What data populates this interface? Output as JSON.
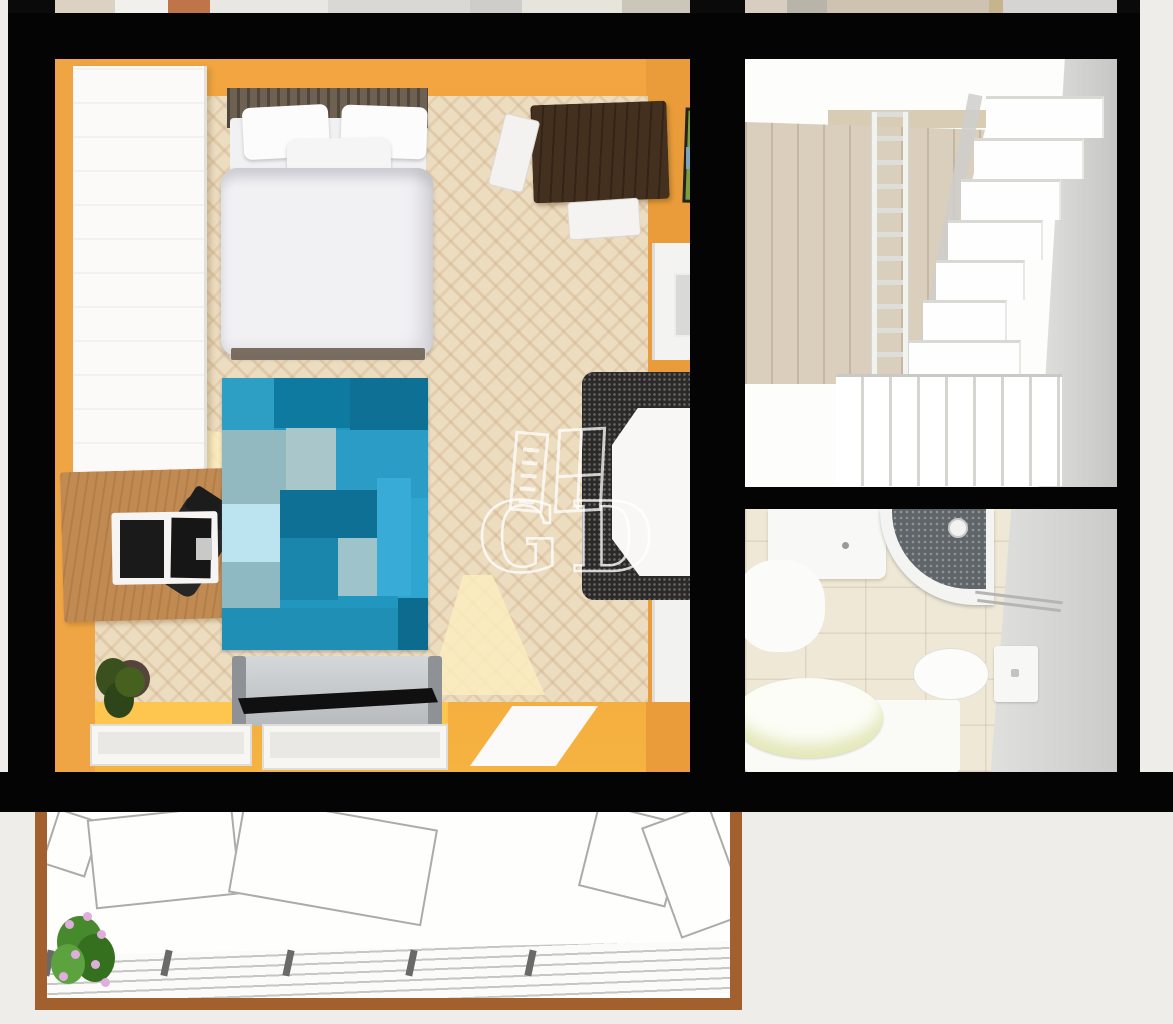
{
  "watermark": {
    "letter_left": "G",
    "letter_right": "D",
    "icons": [
      "ladder-icon",
      "window-frame-icon"
    ],
    "color": "#FFFFFF"
  },
  "palette": {
    "background": "#EFEDE9",
    "wall_black": "#040404",
    "bedroom_wall_orange": "#F2A440",
    "parquet_floor": "#ECDCC0",
    "wardrobe_white": "#FBFAF8",
    "desk_wood": "#C08A52",
    "bed_frame_wood": "#6E6152",
    "bedding_white": "#F1F0F2",
    "rug_base_blue": "#2196BF",
    "tv_stand_silver": "#C9CCCE",
    "tv_black": "#101010",
    "dining_table_dark_wood": "#44301F",
    "stair_white": "#FEFEFE",
    "stair_room_floor_tan": "#DACFBD",
    "bathroom_tile_beige": "#EFE8D7",
    "bathroom_wall_gray": "#CBCBC9",
    "balcony_frame_brown": "#A2602E",
    "plant_green": "#478A2E",
    "flower_pink": "#DFAEDC"
  },
  "scene": {
    "rooms": [
      {
        "name": "bedroom",
        "wall_color": "#F2A440",
        "furniture": [
          "wardrobe",
          "desk",
          "laptop",
          "office-chair",
          "double-bed",
          "pillows",
          "duvet",
          "patchwork-rug",
          "tv-stand",
          "tv",
          "dining-table",
          "white-chairs",
          "speckled-armchair",
          "potted-plant",
          "picture-frame",
          "door-upper",
          "door-lower",
          "window-sills"
        ]
      },
      {
        "name": "staircase-hall",
        "features": [
          "white-staircase",
          "ladder-railing",
          "balustrade",
          "tan-wood-floor",
          "gray-wall"
        ]
      },
      {
        "name": "bathroom",
        "fixtures": [
          "vanity-sink",
          "corner-shower",
          "glass-shelf",
          "toilet",
          "cistern",
          "bathtub"
        ]
      },
      {
        "name": "balcony",
        "features": [
          "brown-wood-frame",
          "plank-decking",
          "railing-posts",
          "open-window-sashes",
          "flowering-plant"
        ]
      }
    ]
  },
  "upper_strip": {
    "segments": [
      {
        "left": 47,
        "width": 60,
        "color": "#DCD2C2"
      },
      {
        "left": 107,
        "width": 55,
        "color": "#F1F0ED"
      },
      {
        "left": 160,
        "width": 42,
        "color": "#C0744A"
      },
      {
        "left": 202,
        "width": 118,
        "color": "#E9E7E3"
      },
      {
        "left": 320,
        "width": 142,
        "color": "#DAD8D4"
      },
      {
        "left": 462,
        "width": 52,
        "color": "#CFCDC9"
      },
      {
        "left": 514,
        "width": 100,
        "color": "#E7E4DC"
      },
      {
        "left": 614,
        "width": 68,
        "color": "#CCC6BA"
      },
      {
        "left": 737,
        "width": 42,
        "color": "#D7CEC1"
      },
      {
        "left": 779,
        "width": 40,
        "color": "#B9B4AA"
      },
      {
        "left": 819,
        "width": 162,
        "color": "#CEC3B0"
      },
      {
        "left": 981,
        "width": 14,
        "color": "#C6B48C"
      },
      {
        "left": 995,
        "width": 114,
        "color": "#D5D4D2"
      }
    ]
  },
  "rug": {
    "patches": [
      {
        "left": 0,
        "top": 0,
        "width": 52,
        "height": 52,
        "color": "#2D9EC4"
      },
      {
        "left": 52,
        "top": 0,
        "width": 76,
        "height": 50,
        "color": "#0F7AA0"
      },
      {
        "left": 128,
        "top": 0,
        "width": 78,
        "height": 58,
        "color": "#0D7094"
      },
      {
        "left": 0,
        "top": 52,
        "width": 64,
        "height": 74,
        "color": "#93B9C0"
      },
      {
        "left": 64,
        "top": 50,
        "width": 50,
        "height": 62,
        "color": "#A9C6CA"
      },
      {
        "left": 114,
        "top": 52,
        "width": 92,
        "height": 68,
        "color": "#2B9CC6"
      },
      {
        "left": 0,
        "top": 126,
        "width": 58,
        "height": 58,
        "color": "#BCE4F0"
      },
      {
        "left": 58,
        "top": 112,
        "width": 118,
        "height": 48,
        "color": "#0D7094"
      },
      {
        "left": 58,
        "top": 160,
        "width": 58,
        "height": 62,
        "color": "#1B86AC"
      },
      {
        "left": 116,
        "top": 160,
        "width": 60,
        "height": 58,
        "color": "#9FC3CA"
      },
      {
        "left": 176,
        "top": 120,
        "width": 30,
        "height": 100,
        "color": "#2FA6D0"
      },
      {
        "left": 0,
        "top": 184,
        "width": 58,
        "height": 46,
        "color": "#8FB9C2"
      },
      {
        "left": 155,
        "top": 100,
        "width": 34,
        "height": 118,
        "color": "#38ACD6"
      },
      {
        "left": 0,
        "top": 230,
        "width": 176,
        "height": 42,
        "color": "#1F8FB5"
      },
      {
        "left": 176,
        "top": 220,
        "width": 30,
        "height": 52,
        "color": "#0C6B8E"
      }
    ]
  },
  "stairs": {
    "steps": [
      {
        "left": 241,
        "top": 37,
        "width": 118,
        "height": 42
      },
      {
        "left": 229,
        "top": 79,
        "width": 110,
        "height": 41
      },
      {
        "left": 216,
        "top": 120,
        "width": 100,
        "height": 41
      },
      {
        "left": 203,
        "top": 161,
        "width": 95,
        "height": 40
      },
      {
        "left": 191,
        "top": 201,
        "width": 89,
        "height": 40
      },
      {
        "left": 178,
        "top": 241,
        "width": 84,
        "height": 40
      },
      {
        "left": 164,
        "top": 281,
        "width": 112,
        "height": 45
      },
      {
        "left": 150,
        "top": 326,
        "width": 134,
        "height": 50
      }
    ]
  },
  "balcony": {
    "posts_x": [
      10,
      128,
      250,
      373,
      492
    ],
    "flowers": [
      {
        "left": 30,
        "top": 108
      },
      {
        "left": 48,
        "top": 100
      },
      {
        "left": 62,
        "top": 118
      },
      {
        "left": 36,
        "top": 138
      },
      {
        "left": 56,
        "top": 148
      },
      {
        "left": 24,
        "top": 160
      },
      {
        "left": 66,
        "top": 166
      }
    ],
    "sashes": [
      {
        "left": 14,
        "top": 2,
        "width": 46,
        "height": 58,
        "rot": 18
      },
      {
        "left": 56,
        "top": 0,
        "width": 146,
        "height": 90,
        "rot": -6
      },
      {
        "left": 200,
        "top": 0,
        "width": 196,
        "height": 98,
        "rot": 10
      },
      {
        "left": 552,
        "top": 0,
        "width": 90,
        "height": 86,
        "rot": 14
      },
      {
        "left": 624,
        "top": 0,
        "width": 72,
        "height": 118,
        "rot": -20
      }
    ]
  }
}
